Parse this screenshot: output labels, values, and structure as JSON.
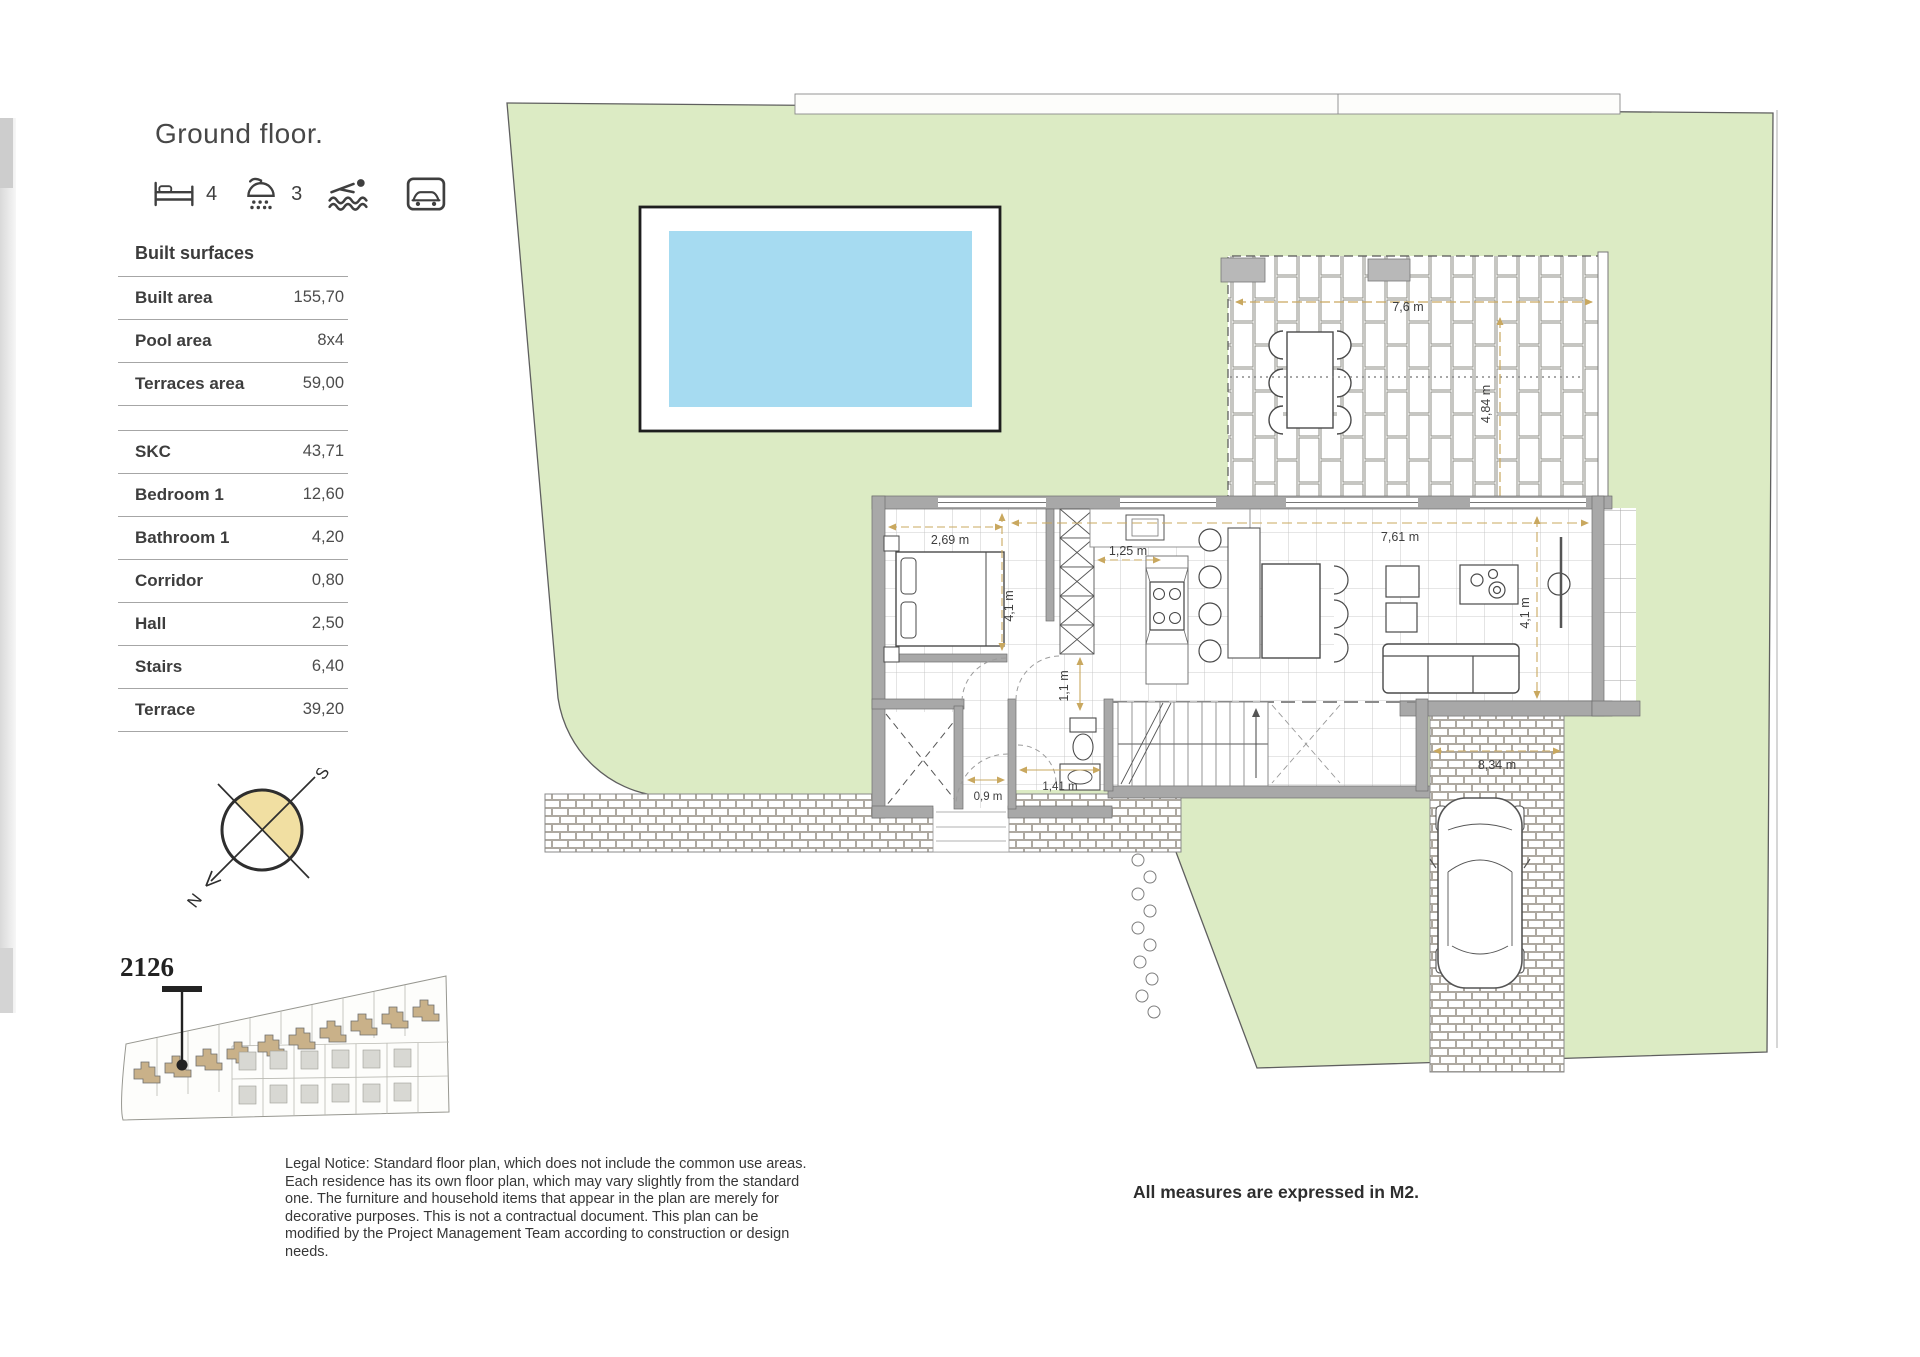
{
  "title": "Ground floor.",
  "features": {
    "bedrooms_count": "4",
    "bathrooms_count": "3"
  },
  "built_surfaces": {
    "heading": "Built surfaces",
    "summary_rows": [
      {
        "label": "Built area",
        "value": "155,70"
      },
      {
        "label": "Pool area",
        "value": "8x4"
      },
      {
        "label": "Terraces area",
        "value": "59,00"
      }
    ],
    "room_rows": [
      {
        "label": "SKC",
        "value": "43,71"
      },
      {
        "label": "Bedroom 1",
        "value": "12,60"
      },
      {
        "label": "Bathroom 1",
        "value": "4,20"
      },
      {
        "label": "Corridor",
        "value": "0,80"
      },
      {
        "label": "Hall",
        "value": "2,50"
      },
      {
        "label": "Stairs",
        "value": "6,40"
      },
      {
        "label": "Terrace",
        "value": "39,20"
      }
    ]
  },
  "compass": {
    "north": "N",
    "south": "S"
  },
  "site_plan": {
    "unit_number": "2126"
  },
  "plan": {
    "dims": {
      "terrace_top_width": "7,6 m",
      "terrace_top_depth": "4,84 m",
      "bedroom_width": "2,69 m",
      "bedroom_depth": "4,1 m",
      "kitchen_width": "1,25 m",
      "living_width": "7,61 m",
      "living_depth": "4,1 m",
      "corridor_width": "1,1 m",
      "hall_width": "0,9 m",
      "bathroom_width": "1,41 m",
      "driveway_length": "8,34 m"
    }
  },
  "footer": {
    "legal_notice": "Legal Notice: Standard floor plan, which does not include the common use areas. Each residence has its own floor plan, which may vary slightly from the standard one. The furniture and household items that appear in the plan are merely for decorative purposes. This is not a contractual document. This plan can be modified by the Project Management Team according to construction or design needs.",
    "measures_note": "All measures are expressed in M2."
  },
  "colors": {
    "plot_green": "#dcebc4",
    "pool_blue": "#a6dbf1",
    "compass_yellow": "#f1dfa2",
    "dimension_tan": "#c9a85f",
    "house_tan": "#c9b189"
  }
}
